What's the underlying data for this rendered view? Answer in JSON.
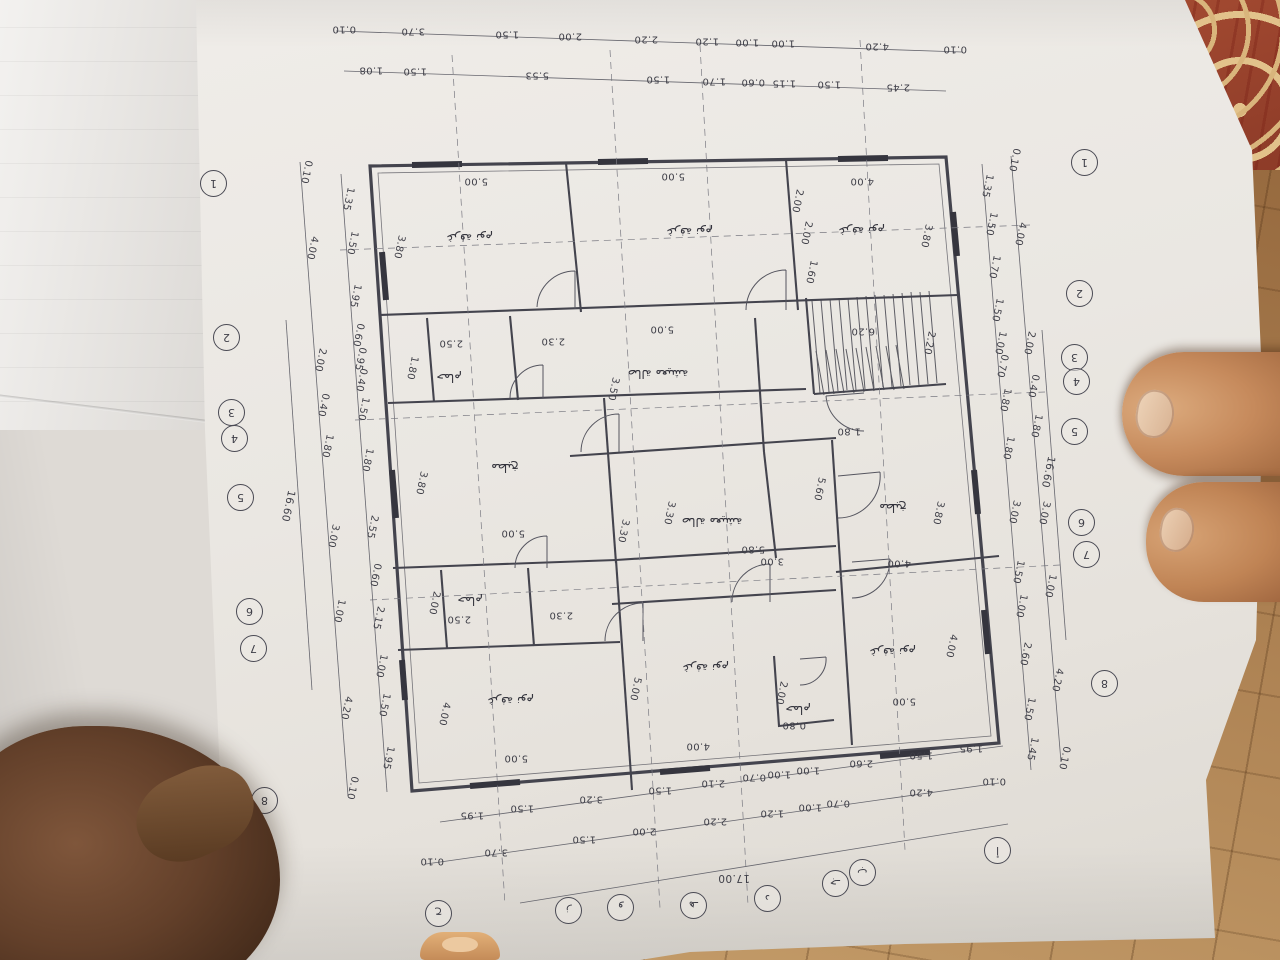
{
  "scene": {
    "kind": "photo of an architectural floor-plan sheet lying rotated 180° on a tiled floor, held by fingers",
    "colors": {
      "paper": "#eae7e2",
      "ink": "#3e3e47",
      "floor_tile": "#a87c4e",
      "carpet": "#a34a31",
      "skin_light": "#c68a5c",
      "skin_dark": "#63402a",
      "nail": "#eed4b9"
    }
  },
  "plan": {
    "room_labels": [
      {
        "t": "غرفة نوم",
        "x": 470,
        "y": 238
      },
      {
        "t": "غرفة نوم",
        "x": 690,
        "y": 232
      },
      {
        "t": "غرفة نوم",
        "x": 862,
        "y": 231
      },
      {
        "t": "حمام",
        "x": 449,
        "y": 378
      },
      {
        "t": "مطبخ",
        "x": 505,
        "y": 468
      },
      {
        "t": "صالة معيشة",
        "x": 658,
        "y": 374
      },
      {
        "t": "صالة معيشة",
        "x": 712,
        "y": 522
      },
      {
        "t": "مطبخ",
        "x": 893,
        "y": 508
      },
      {
        "t": "حمام",
        "x": 470,
        "y": 601
      },
      {
        "t": "غرفة نوم",
        "x": 511,
        "y": 701
      },
      {
        "t": "غرفة نوم",
        "x": 706,
        "y": 668
      },
      {
        "t": "حمام",
        "x": 798,
        "y": 710
      },
      {
        "t": "غرفة نوم",
        "x": 893,
        "y": 652
      }
    ],
    "interior_dims": [
      {
        "t": "5.00",
        "x": 476,
        "y": 181
      },
      {
        "t": "3.80",
        "x": 399,
        "y": 247,
        "r": 102
      },
      {
        "t": "5.00",
        "x": 673,
        "y": 176
      },
      {
        "t": "5.00",
        "x": 662,
        "y": 329
      },
      {
        "t": "4.00",
        "x": 862,
        "y": 181
      },
      {
        "t": "3.80",
        "x": 926,
        "y": 236,
        "r": 102
      },
      {
        "t": "2.00",
        "x": 797,
        "y": 201,
        "r": 102
      },
      {
        "t": "2.00",
        "x": 806,
        "y": 233,
        "r": 102
      },
      {
        "t": "1.60",
        "x": 811,
        "y": 272,
        "r": 102
      },
      {
        "t": "6.20",
        "x": 863,
        "y": 331
      },
      {
        "t": "2.20",
        "x": 929,
        "y": 343,
        "r": 102
      },
      {
        "t": "2.50",
        "x": 451,
        "y": 343
      },
      {
        "t": "2.30",
        "x": 553,
        "y": 341
      },
      {
        "t": "1.80",
        "x": 412,
        "y": 368,
        "r": 102
      },
      {
        "t": "3.80",
        "x": 421,
        "y": 483,
        "r": 102
      },
      {
        "t": "5.00",
        "x": 513,
        "y": 533
      },
      {
        "t": "3.50",
        "x": 613,
        "y": 389,
        "r": 102
      },
      {
        "t": "1.80",
        "x": 849,
        "y": 431
      },
      {
        "t": "5.60",
        "x": 819,
        "y": 489,
        "r": 102
      },
      {
        "t": "3.30",
        "x": 623,
        "y": 531,
        "r": 102
      },
      {
        "t": "3.30",
        "x": 669,
        "y": 513,
        "r": 102
      },
      {
        "t": "5.80",
        "x": 753,
        "y": 549
      },
      {
        "t": "3.00",
        "x": 772,
        "y": 561
      },
      {
        "t": "3.80",
        "x": 938,
        "y": 513,
        "r": 102
      },
      {
        "t": "4.00",
        "x": 899,
        "y": 563
      },
      {
        "t": "2.00",
        "x": 434,
        "y": 603,
        "r": 102
      },
      {
        "t": "2.50",
        "x": 459,
        "y": 619
      },
      {
        "t": "2.30",
        "x": 561,
        "y": 615
      },
      {
        "t": "4.00",
        "x": 444,
        "y": 714,
        "r": 102
      },
      {
        "t": "5.00",
        "x": 516,
        "y": 758
      },
      {
        "t": "5.00",
        "x": 635,
        "y": 689,
        "r": 102
      },
      {
        "t": "4.00",
        "x": 698,
        "y": 746
      },
      {
        "t": "2.00",
        "x": 781,
        "y": 693,
        "r": 102
      },
      {
        "t": "0.80",
        "x": 794,
        "y": 725
      },
      {
        "t": "4.00",
        "x": 951,
        "y": 646,
        "r": 102
      },
      {
        "t": "5.00",
        "x": 904,
        "y": 701
      }
    ],
    "totals": [
      {
        "t": "17.00",
        "x": 734,
        "y": 878
      },
      {
        "t": "16.60",
        "x": 288,
        "y": 506,
        "r": 102
      },
      {
        "t": "16.60",
        "x": 1048,
        "y": 472,
        "r": 102
      }
    ],
    "dim_chains": [
      {
        "name": "top-outer",
        "x1": 342,
        "y1": 29,
        "x2": 957,
        "y2": 49,
        "r": 180,
        "values": [
          "0.10",
          "3.70",
          "1.50",
          "2.00",
          "2.20",
          "1.20",
          "1.00",
          "1.00",
          "4.20",
          "0.10"
        ]
      },
      {
        "name": "top-inner",
        "x1": 352,
        "y1": 69,
        "x2": 940,
        "y2": 88,
        "r": 180,
        "values": [
          "1.08",
          "1.50",
          "5.53",
          "1.50",
          "1.70",
          "0.60",
          "1.15",
          "1.50",
          "2.45"
        ]
      },
      {
        "name": "bottom-outer",
        "x1": 430,
        "y1": 861,
        "x2": 996,
        "y2": 781,
        "r": 180,
        "values": [
          "0.10",
          "3.70",
          "1.50",
          "2.00",
          "2.20",
          "1.20",
          "1.00",
          "0.70",
          "4.20",
          "0.10"
        ]
      },
      {
        "name": "bottom-inner",
        "x1": 443,
        "y1": 819,
        "x2": 1000,
        "y2": 744,
        "r": 180,
        "values": [
          "1.95",
          "1.50",
          "3.20",
          "1.50",
          "2.10",
          "0.70",
          "1.00",
          "1.00",
          "2.60",
          "1.50",
          "1.95"
        ]
      },
      {
        "name": "left-middle",
        "x1": 306,
        "y1": 170,
        "x2": 352,
        "y2": 790,
        "r": 102,
        "values": [
          "0.10",
          "4.00",
          "2.00",
          "0.40",
          "1.80",
          "3.00",
          "1.00",
          "4.20",
          "0.10"
        ]
      },
      {
        "name": "left-inner",
        "x1": 347,
        "y1": 178,
        "x2": 390,
        "y2": 788,
        "r": 102,
        "values": [
          "1.35",
          "1.50",
          "1.95",
          "0.60",
          "0.95",
          "0.40",
          "1.50",
          "1.80",
          "2.55",
          "0.60",
          "2.15",
          "1.00",
          "1.50",
          "1.95"
        ]
      },
      {
        "name": "right-inner",
        "x1": 986,
        "y1": 168,
        "x2": 1034,
        "y2": 768,
        "r": 102,
        "values": [
          "1.35",
          "1.50",
          "1.70",
          "1.50",
          "1.00",
          "0.70",
          "1.80",
          "1.80",
          "3.00",
          "1.50",
          "1.00",
          "2.60",
          "1.50",
          "1.45"
        ]
      },
      {
        "name": "right-middle",
        "x1": 1014,
        "y1": 158,
        "x2": 1064,
        "y2": 760,
        "r": 102,
        "values": [
          "0.10",
          "4.00",
          "2.00",
          "0.40",
          "1.80",
          "3.00",
          "1.00",
          "4.20",
          "0.10"
        ]
      }
    ],
    "grid_bubbles": [
      {
        "axis": "left",
        "items": [
          {
            "t": "1",
            "x": 213,
            "y": 183
          },
          {
            "t": "2",
            "x": 226,
            "y": 337
          },
          {
            "t": "3",
            "x": 231,
            "y": 412
          },
          {
            "t": "4",
            "x": 234,
            "y": 438
          },
          {
            "t": "5",
            "x": 240,
            "y": 497
          },
          {
            "t": "6",
            "x": 249,
            "y": 611
          },
          {
            "t": "7",
            "x": 253,
            "y": 648
          },
          {
            "t": "8",
            "x": 264,
            "y": 800
          }
        ]
      },
      {
        "axis": "right",
        "items": [
          {
            "t": "1",
            "x": 1084,
            "y": 162
          },
          {
            "t": "2",
            "x": 1079,
            "y": 293
          },
          {
            "t": "3",
            "x": 1074,
            "y": 357
          },
          {
            "t": "4",
            "x": 1076,
            "y": 381
          },
          {
            "t": "5",
            "x": 1074,
            "y": 431
          },
          {
            "t": "6",
            "x": 1081,
            "y": 522
          },
          {
            "t": "7",
            "x": 1086,
            "y": 554
          },
          {
            "t": "8",
            "x": 1104,
            "y": 683
          }
        ]
      },
      {
        "axis": "bottom",
        "items": [
          {
            "t": "أ",
            "x": 997,
            "y": 850
          },
          {
            "t": "ب",
            "x": 862,
            "y": 872
          },
          {
            "t": "جـ",
            "x": 835,
            "y": 883
          },
          {
            "t": "د",
            "x": 767,
            "y": 898
          },
          {
            "t": "هـ",
            "x": 693,
            "y": 905
          },
          {
            "t": "و",
            "x": 620,
            "y": 907
          },
          {
            "t": "ز",
            "x": 568,
            "y": 910
          },
          {
            "t": "ح",
            "x": 438,
            "y": 913
          }
        ]
      }
    ]
  }
}
